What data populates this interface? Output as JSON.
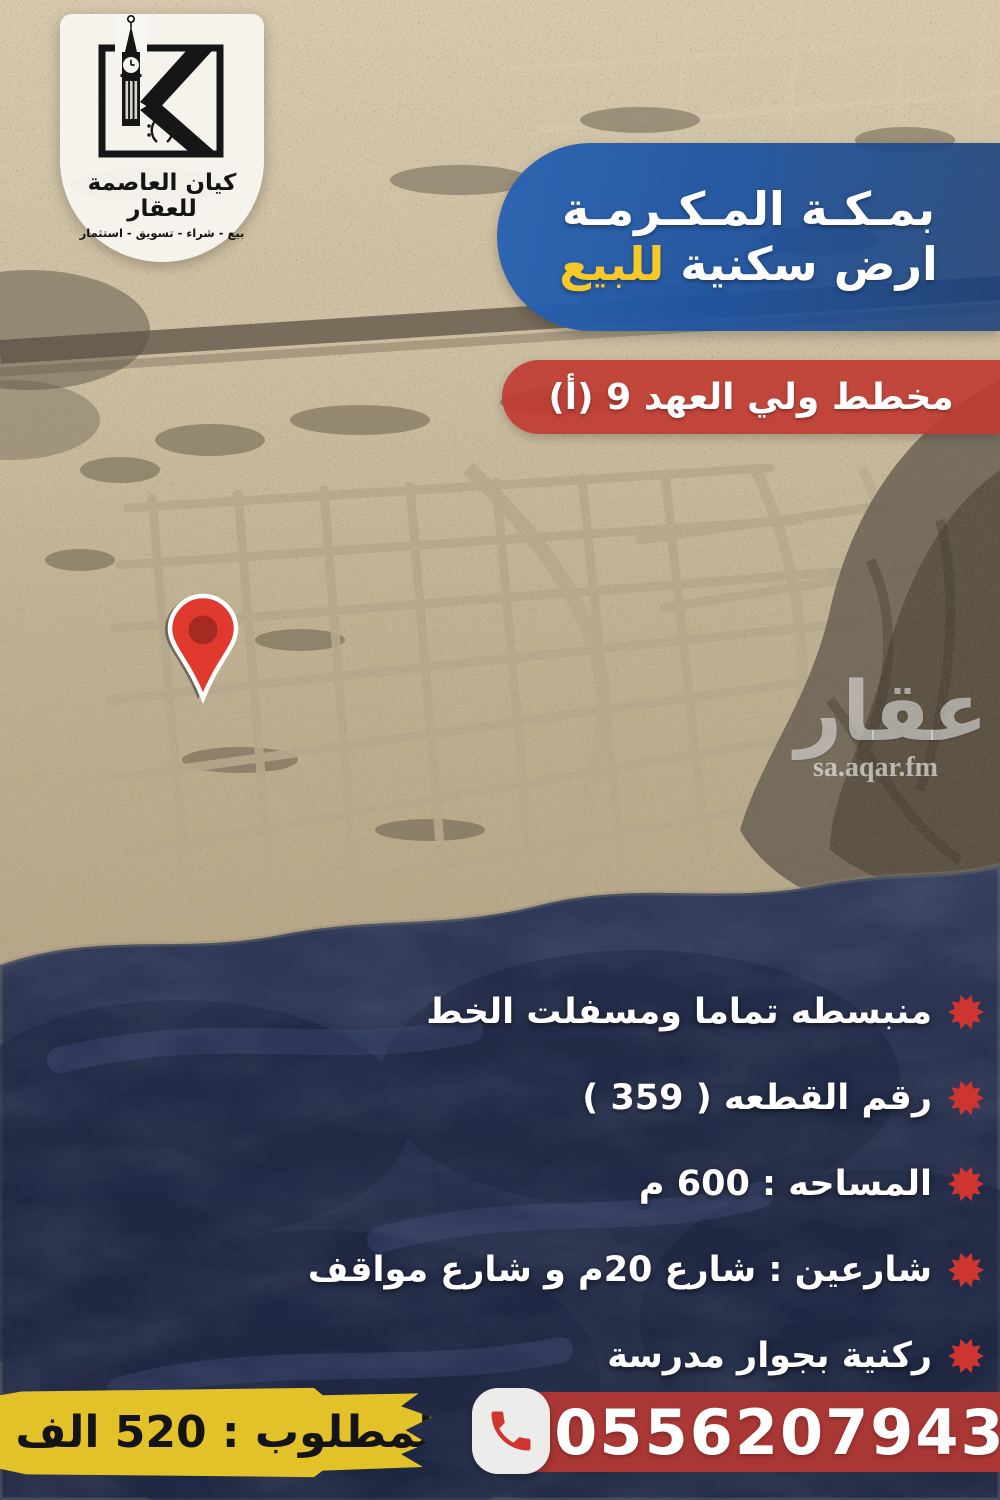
{
  "logo": {
    "monogram": "K",
    "company_name": "كيان العاصمة للعقار",
    "tagline": "بيع - شراء - تسويق - استثمار"
  },
  "header": {
    "city_line": "بمـكـة المـكـرمـة",
    "offer_line_white": "ارض سكنية",
    "offer_line_highlight": "للبيع"
  },
  "plan_badge": {
    "label": "مخطط ولي العهد 9 (أ)"
  },
  "features": {
    "items": [
      "منبسطه تماما ومسفلت الخط",
      "رقم القطعه ( 359 )",
      "المساحه : 600 م",
      "شارعين : شارع 20م و شارع مواقف",
      "ركنية بجوار مدرسة"
    ]
  },
  "footer": {
    "price_label": "المطلوب : 520 الف",
    "phone_number": "0556207943"
  },
  "watermark": {
    "brand": "عقار",
    "site": "sa.aqar.fm"
  },
  "icons": {
    "map_pin": "red teardrop location pin",
    "phone": "red phone handset in white rounded square",
    "feature_bullet": "red starburst seal",
    "logo_emblem": "clock-tower K monogram in square frame"
  },
  "colors": {
    "banner_blue": "#1f55a4",
    "highlight_yellow": "#f6c92b",
    "badge_red": "#c0382f",
    "price_yellow": "#e3c229",
    "phone_band_red": "#b13834",
    "pin_red": "#e03a2f",
    "desert_tan": "#c9bb9f",
    "mountain_navy": "#27304c"
  }
}
